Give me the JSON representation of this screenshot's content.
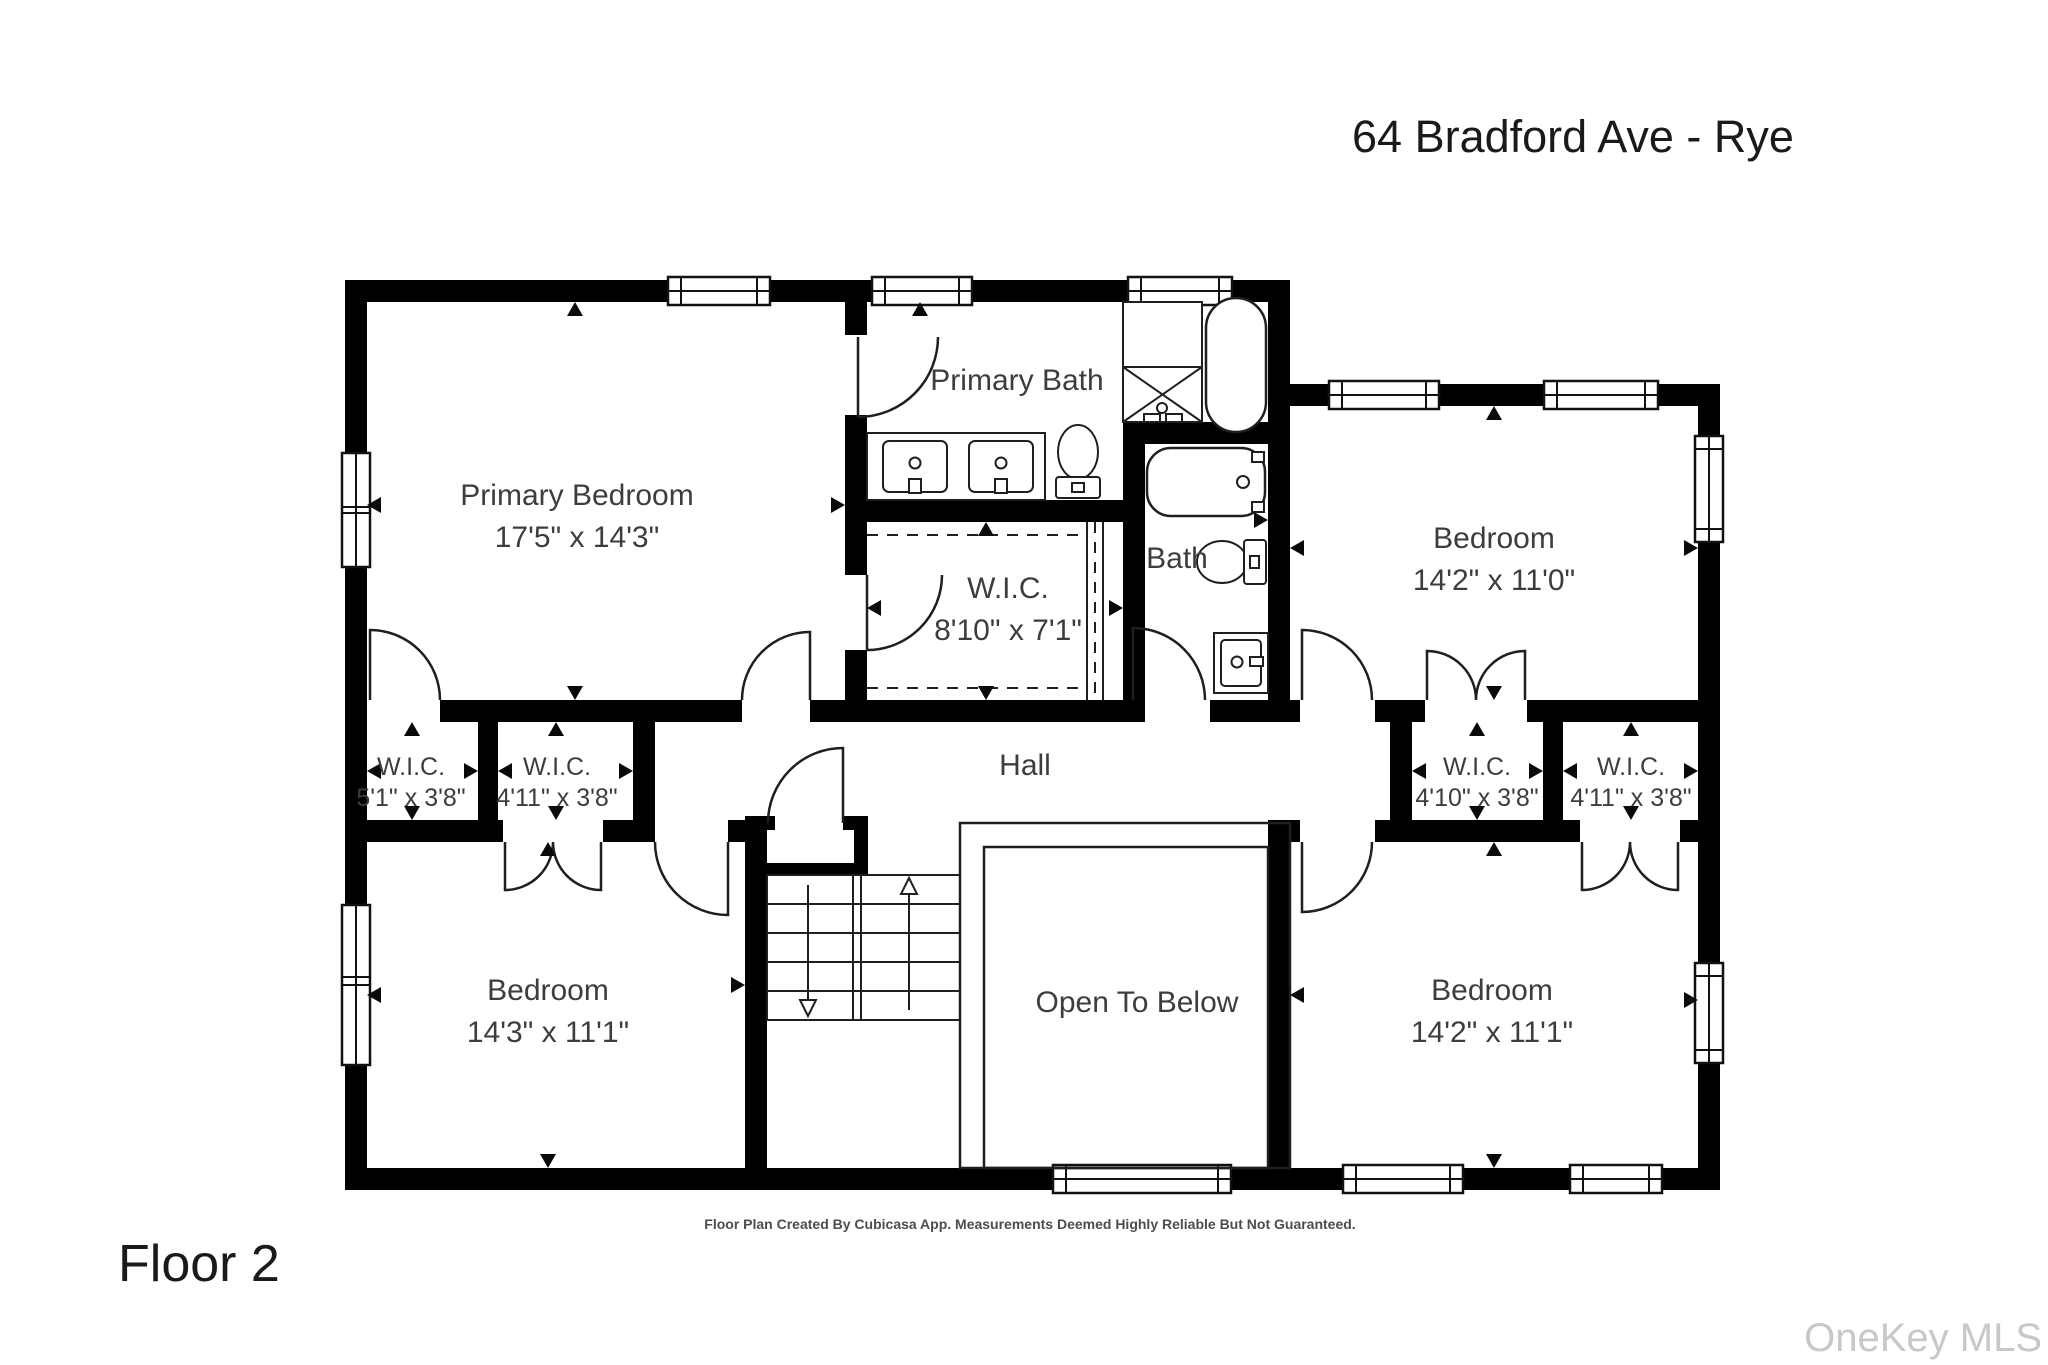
{
  "page": {
    "title": "64 Bradford Ave - Rye",
    "floor_label": "Floor 2",
    "disclaimer": "Floor Plan Created By Cubicasa App. Measurements Deemed Highly Reliable But Not Guaranteed.",
    "watermark": "OneKey MLS"
  },
  "rooms": {
    "primary_bedroom": {
      "name": "Primary Bedroom",
      "dims": "17'5\" x 14'3\""
    },
    "primary_bath": {
      "name": "Primary Bath"
    },
    "wic_main": {
      "name": "W.I.C.",
      "dims": "8'10\" x 7'1\""
    },
    "bath": {
      "name": "Bath"
    },
    "bedroom_top_right": {
      "name": "Bedroom",
      "dims": "14'2\" x 11'0\""
    },
    "wic_left_1": {
      "name": "W.I.C.",
      "dims": "5'1\" x 3'8\""
    },
    "wic_left_2": {
      "name": "W.I.C.",
      "dims": "4'11\" x 3'8\""
    },
    "hall": {
      "name": "Hall"
    },
    "wic_right_1": {
      "name": "W.I.C.",
      "dims": "4'10\" x 3'8\""
    },
    "wic_right_2": {
      "name": "W.I.C.",
      "dims": "4'11\" x 3'8\""
    },
    "bedroom_bottom_left": {
      "name": "Bedroom",
      "dims": "14'3\" x 11'1\""
    },
    "open_to_below": {
      "name": "Open To Below"
    },
    "bedroom_bottom_right": {
      "name": "Bedroom",
      "dims": "14'2\" x 11'1\""
    }
  },
  "icons": {
    "stairs_up": "arrow-up",
    "stairs_down": "arrow-down"
  },
  "colors": {
    "wall": "#000000",
    "line": "#1f1f1f",
    "label": "#3d3d3d",
    "title": "#1a1a1a",
    "footer": "#4d4d4d",
    "watermark": "#c8c8c8",
    "background": "#ffffff"
  }
}
